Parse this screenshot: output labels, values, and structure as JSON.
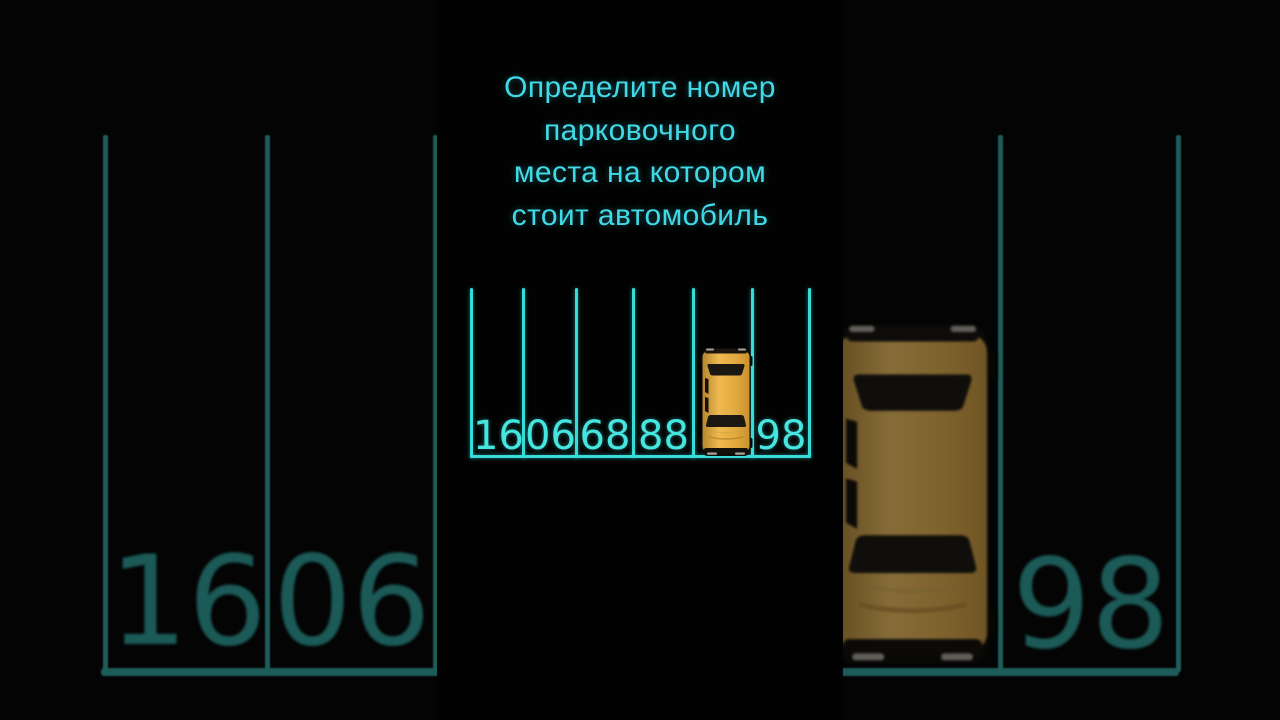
{
  "question": {
    "lines": [
      "Определите номер",
      "парковочного",
      "места на котором",
      "стоит автомобиль"
    ],
    "full_text": "Определите номер парковочного места на котором стоит автомобиль"
  },
  "parking": {
    "spots": [
      "16",
      "06",
      "68",
      "88",
      "",
      "98"
    ],
    "occupied_spot_index": 4,
    "occupant": "yellow-toy-car"
  },
  "background_mirror": {
    "big_numbers_left": [
      "16",
      "06"
    ],
    "big_number_right": "98",
    "occupant": "yellow-toy-car-enlarged-dimmed"
  },
  "icons": {
    "car": "top-down-yellow-car-icon"
  },
  "colors": {
    "accent_cyan": "#41d9e6",
    "line_cyan": "#36ddd8",
    "number_cyan": "#45e6e0",
    "dim_line_teal": "#1e5c59",
    "dim_number_teal": "#1b5a57",
    "car_yellow": "#e7ab41",
    "side_bg": "#040404",
    "panel_bg": "#020202"
  }
}
